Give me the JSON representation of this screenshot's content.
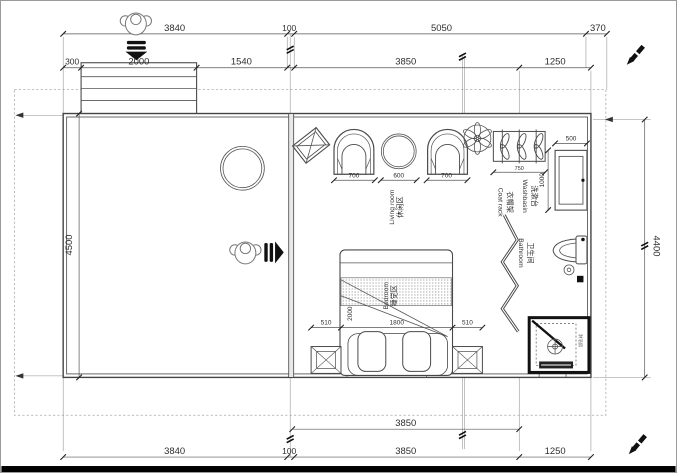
{
  "colors": {
    "background": "#ffffff",
    "linework": "#4a4a4a",
    "dimension_text": "#2e2e2e",
    "accent_black": "#111111",
    "boundary_dash": "#a8a8a8",
    "bottom_bar": "#000000"
  },
  "dimensions": {
    "top_primary": [
      "3840",
      "100",
      "5050",
      "370"
    ],
    "top_secondary": [
      "300",
      "2000",
      "1540",
      "3850",
      "1250"
    ],
    "left_height": "4500",
    "right_height": "4400",
    "bottom_inner": "3850",
    "bottom_primary": [
      "3840",
      "100",
      "3850",
      "1250"
    ],
    "seating": [
      "700",
      "600",
      "700"
    ],
    "coat_rack_width": "750",
    "washbasin_width": "500",
    "washbasin_length": "1000",
    "bed_row": [
      "510",
      "1800",
      "510"
    ],
    "bed_length": "2000"
  },
  "rooms": {
    "living": {
      "zh": "休闲区",
      "en": "Living room"
    },
    "bedroom": {
      "zh": "睡觉区",
      "en": "Bedroom"
    },
    "coat_rack": {
      "zh": "衣帽架",
      "en": "Coat rack"
    },
    "washbasin": {
      "zh": "洗漱台",
      "en": "Washbasin"
    },
    "bathroom": {
      "zh": "卫生间",
      "en": "Bathroom"
    },
    "shower": {
      "zh": "淋浴房"
    }
  },
  "icons": {
    "top_entry": "person-top-view-icon + down-arrow",
    "side_entry": "person-top-view-icon + right-arrow",
    "ceiling_fan": "ceiling-fan-icon",
    "corner_markers": "pen-icon"
  }
}
